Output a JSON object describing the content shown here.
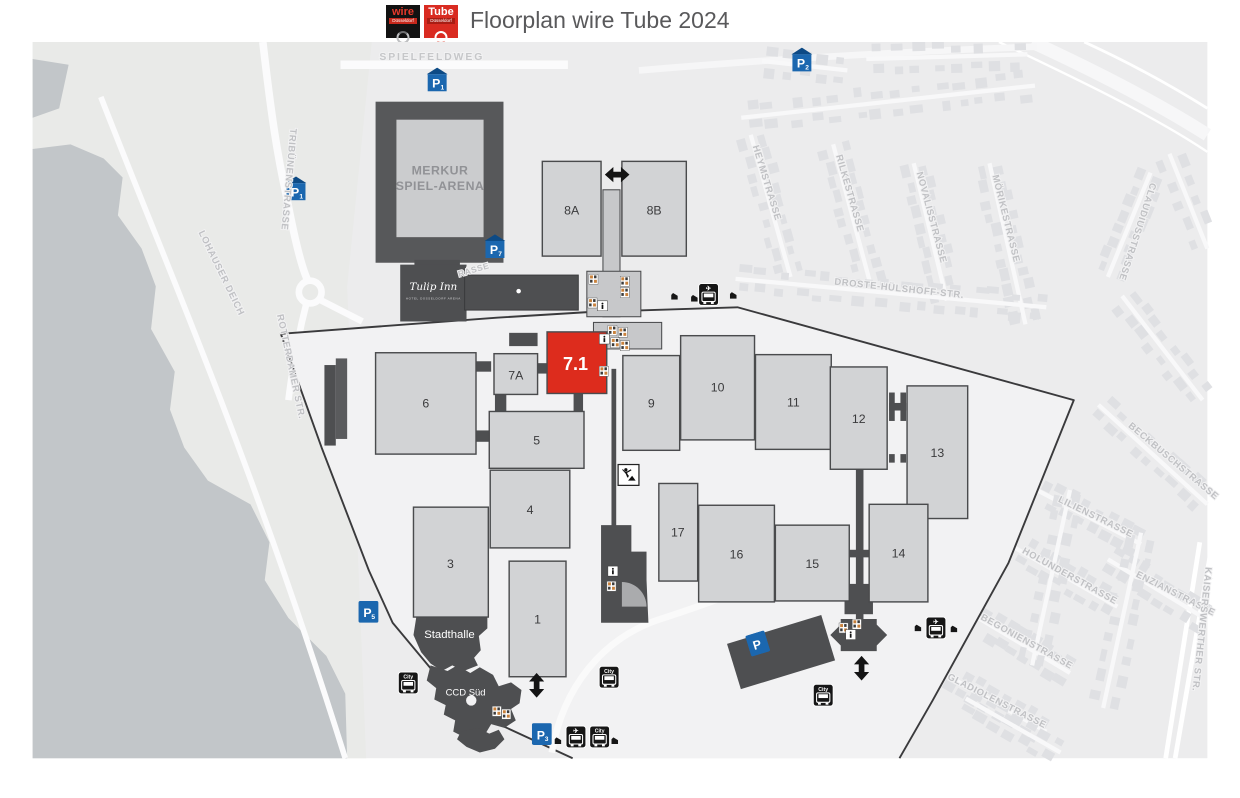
{
  "header": {
    "title": "Floorplan wire Tube 2024",
    "logos": {
      "wire": {
        "name": "wire",
        "city": "Düsseldorf"
      },
      "tube": {
        "name": "Tube",
        "city": "Düsseldorf"
      }
    }
  },
  "map": {
    "halls": [
      {
        "label": "8A"
      },
      {
        "label": "8B"
      },
      {
        "label": "7A"
      },
      {
        "label": "7.1",
        "highlight": true
      },
      {
        "label": "6"
      },
      {
        "label": "5"
      },
      {
        "label": "4"
      },
      {
        "label": "3"
      },
      {
        "label": "1"
      },
      {
        "label": "9"
      },
      {
        "label": "10"
      },
      {
        "label": "11"
      },
      {
        "label": "12"
      },
      {
        "label": "13"
      },
      {
        "label": "17"
      },
      {
        "label": "16"
      },
      {
        "label": "15"
      },
      {
        "label": "14"
      }
    ],
    "buildings": {
      "arena": {
        "name": "MERKUR SPIEL-ARENA",
        "line1": "MERKUR",
        "line2": "SPIEL-ARENA"
      },
      "hotel": {
        "script": "Tulip Inn",
        "sub": "HOTEL DÜSSELDORF ARENA"
      },
      "stadthalle": {
        "name": "Stadthalle"
      },
      "ccd": {
        "name": "CCD Süd"
      }
    },
    "streets": [
      {
        "name": "SPIELFELDWEG"
      },
      {
        "name": "TRIBÜNENSTRASSE"
      },
      {
        "name": "LOHAUSER DEICH"
      },
      {
        "name": "ROTTERDAMER STR."
      },
      {
        "name": "HEYMSTRASSE"
      },
      {
        "name": "RILKESTRASSE"
      },
      {
        "name": "NOVALISSTRASSE"
      },
      {
        "name": "MÖRIKESTRASSE"
      },
      {
        "name": "CLAUDIUSSTRASSE"
      },
      {
        "name": "DROSTE-HÜLSHOFF-STR."
      },
      {
        "name": "BECKBUSCHSTRASSE"
      },
      {
        "name": "LILIENSTRASSE"
      },
      {
        "name": "HOLUNDERSTRASSE"
      },
      {
        "name": "ENZIANSTRASSE"
      },
      {
        "name": "BEGONIENSTRASSE"
      },
      {
        "name": "GLADIOLENSTRASSE"
      },
      {
        "name": "KAISERSWERTHER STR."
      },
      {
        "name": "RASSE"
      }
    ],
    "parking": [
      {
        "label": "P",
        "sub": "1",
        "covered": true
      },
      {
        "label": "P",
        "sub": "1",
        "covered": true
      },
      {
        "label": "P",
        "sub": "7",
        "covered": true
      },
      {
        "label": "P",
        "sub": "2",
        "covered": true
      },
      {
        "label": "P",
        "sub": "5",
        "covered": false
      },
      {
        "label": "P",
        "sub": "3",
        "covered": false
      },
      {
        "label": "P",
        "sub": "",
        "covered": false
      }
    ],
    "bus": {
      "city_label": "City",
      "plane_glyph": "✈"
    },
    "colors": {
      "highlight_hall": "#dd2c1d",
      "hall_fill": "#d2d3d5",
      "dark_building": "#4e4f51",
      "parking_blue": "#1b67af",
      "water": "#c2c6c9",
      "boundary": "#3a3a3c"
    }
  }
}
